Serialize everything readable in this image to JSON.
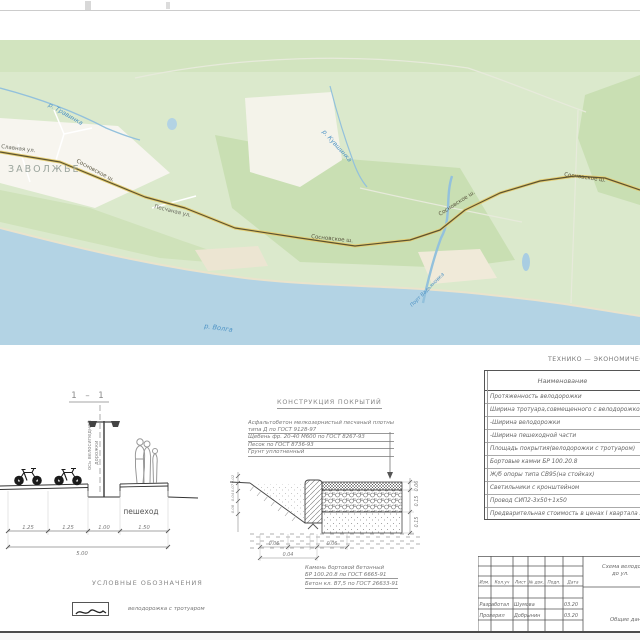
{
  "map": {
    "district": "ЗАВОЛЖЬЕ",
    "street_slavnaya": "Славная ул.",
    "street_peschanaya": "Песчаная ул.",
    "road_sosnovskoe": "Сосновское ш.",
    "river_travinka": "р. Травинка",
    "river_kuvshinka": "р. Кувшинка",
    "river_volga": "р. Волга",
    "river_port": "Порт Вадьяновка"
  },
  "section": {
    "title": "1 – 1",
    "axis_label_line1": "ось велосипедной",
    "axis_label_line2": "дорожки",
    "pedestrian_label": "пешеход",
    "dim1": "1.25",
    "dim2": "1.25",
    "dim3": "1.00",
    "dim4": "1.50",
    "dim_total": "5.00"
  },
  "construction": {
    "title": "КОНСТРУКЦИЯ ПОКРЫТИЙ",
    "line1": "Асфальтобетон мелкозернистый песчаный плотный",
    "line2": "типа Д по ГОСТ 9128-97",
    "line3": "Щебень фр. 20-40 М600 по ГОСТ 8267-93",
    "line4": "Песок по ГОСТ 8736-93",
    "line5": "Грунт уплотненный",
    "dim_right1": "0.06",
    "dim_right2": "0.15",
    "dim_right3": "0.15",
    "dim_left1": "0.02",
    "dim_left2": "0.07",
    "dim_left3": "0.04",
    "dim_left4": "0.08",
    "dim_bottom1": "0.06",
    "dim_bottom2": "0.06",
    "dim_bottom3": "0.04",
    "note1": "Камень бортовой бетонный",
    "note2": "БР 100.20.8 по ГОСТ 6665-91",
    "note3": "Бетон кл. В7,5 по ГОСТ 26633-91"
  },
  "teo": {
    "title": "ТЕХНИКО — ЭКОНОМИЧЕСКИЕ",
    "header": "Наименование",
    "rows": [
      "Протяженность велодорожки",
      "Ширина тротуара,совмещенного с велодорожкой",
      "-Ширина велодорожки",
      "-Ширина пешеходной части",
      "Площадь покрытия(велодорожки с тротуаром)",
      "Бортовые камни БР 100.20.8",
      "Ж/б опоры типа СВ95(на стойках)",
      "Светильники с кронштейном",
      "Провод СИП2-3х50+1х50",
      "Предварительная стоимость в ценах I квартала 2020"
    ]
  },
  "legend": {
    "title": "УСЛОВНЫЕ ОБОЗНАЧЕНИЯ",
    "item1": "велодорожка с тротуаром"
  },
  "stamp": {
    "col1": "Изм.",
    "col2": "Кол.уч",
    "col3": "Лист",
    "col4": "№ док.",
    "col5": "Подп.",
    "col6": "Дата",
    "row1_role": "Разработал",
    "row1_name": "Шумова",
    "row1_date": "03.20",
    "row2_role": "Проверил",
    "row2_name": "Добрынин",
    "row2_date": "03.20",
    "doc_title1": "Схема велодорожки",
    "doc_title2": "до ул.",
    "doc_stage": "Общие данные"
  }
}
